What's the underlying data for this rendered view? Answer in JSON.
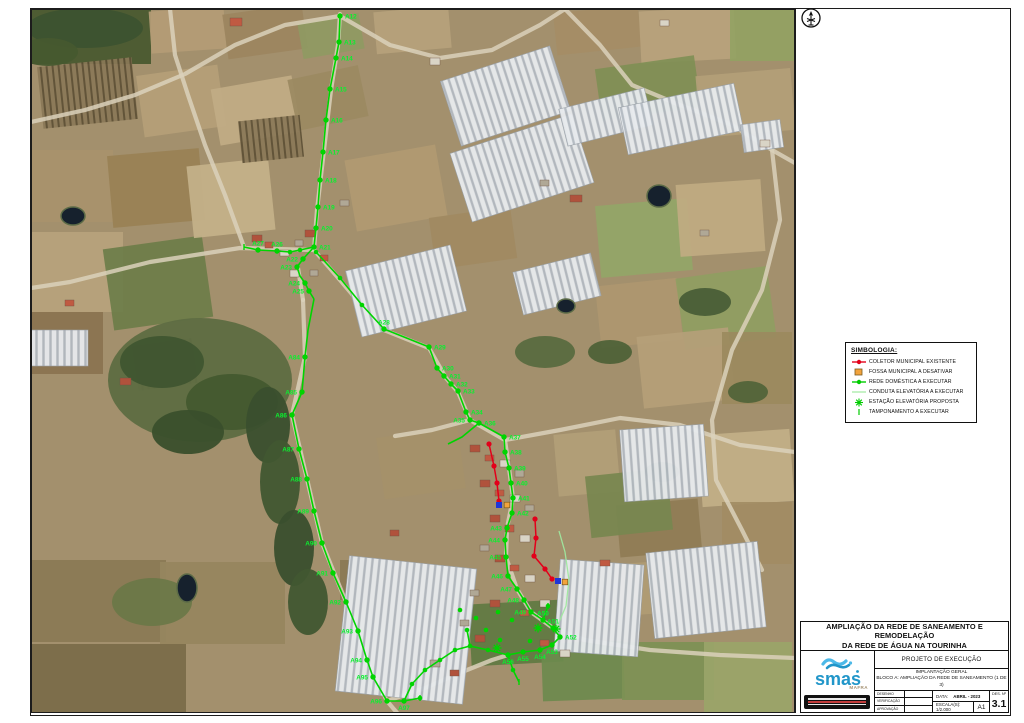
{
  "sheet": {
    "title_line1": "AMPLIAÇÃO DA  REDE DE SANEAMENTO E REMODELAÇÃO",
    "title_line2": "DA REDE DE ÁGUA NA TOURINHA",
    "project_phase": "PROJETO DE EXECUÇÃO",
    "subtitle1": "IMPLANTAÇÃO GERAL",
    "subtitle2": "BLOCO A: AMPLIAÇÃO DA REDE DE SANEAMENTO (1 DE 3)",
    "sign_rows": [
      {
        "label": "DESENHO"
      },
      {
        "label": "VERIFICAÇÃO"
      },
      {
        "label": "APROVAÇÃO"
      }
    ],
    "date_label": "DATA:",
    "date_value": "ABRIL - 2023",
    "scale_label": "ESCALA(S):  1/2.000",
    "format": "A1",
    "des_label": "DES. Nº",
    "des_number": "3.1",
    "logo_text": "smas",
    "logo_subtext": "MAFRA"
  },
  "legend": {
    "title": "SIMBOLOGIA:",
    "items": [
      {
        "symbol": "red-line-dot",
        "label": "COLETOR MUNICIPAL EXISTENTE",
        "color": "#e2001a"
      },
      {
        "symbol": "orange-square",
        "label": "FOSSA MUNICIPAL A DESATIVAR",
        "color": "#f2a33c"
      },
      {
        "symbol": "green-line-dot",
        "label": "REDE DOMÉSTICA A EXECUTAR",
        "color": "#00cc00"
      },
      {
        "symbol": "pale-green-line",
        "label": "CONDUTA ELEVATÓRIA A EXECUTAR",
        "color": "#9fe89f"
      },
      {
        "symbol": "green-star",
        "label": "ESTAÇÃO ELEVATÓRIA PROPOSTA",
        "color": "#00cc00"
      },
      {
        "symbol": "green-tick",
        "label": "TAMPONAMENTO A EXECUTAR",
        "color": "#00cc00"
      }
    ]
  },
  "map": {
    "colors": {
      "network_green": "#00d400",
      "label_green": "#0bef2f",
      "coletor_red": "#e2001a",
      "fossa_orange": "#f2a33c",
      "marker_blue": "#1e36d9",
      "conduta_pale": "#9fe89f"
    },
    "nodes": [
      [
        "A12",
        340,
        16,
        "r"
      ],
      [
        "A13",
        339,
        42,
        "r"
      ],
      [
        "A14",
        336,
        58,
        "r"
      ],
      [
        "A15",
        330,
        89,
        "r"
      ],
      [
        "A16",
        326,
        120,
        "r"
      ],
      [
        "A17",
        323,
        152,
        "r"
      ],
      [
        "A18",
        320,
        180,
        "r"
      ],
      [
        "A19",
        318,
        207,
        "r"
      ],
      [
        "A20",
        316,
        228,
        "r"
      ],
      [
        "A21",
        314,
        247,
        "r"
      ],
      [
        "A27",
        258,
        250,
        "t"
      ],
      [
        "A26",
        277,
        251,
        "t"
      ],
      [
        "A22",
        303,
        259,
        "l"
      ],
      [
        "A23",
        297,
        267,
        "l"
      ],
      [
        "A24",
        305,
        283,
        "l"
      ],
      [
        "A25",
        309,
        291,
        "l"
      ],
      [
        "A28",
        384,
        329,
        "t"
      ],
      [
        "A29",
        429,
        347,
        "r"
      ],
      [
        "A30",
        437,
        368,
        "r"
      ],
      [
        "A31",
        444,
        376,
        "r"
      ],
      [
        "A32",
        451,
        384,
        "r"
      ],
      [
        "A33",
        458,
        391,
        "r"
      ],
      [
        "A34",
        466,
        412,
        "r"
      ],
      [
        "A35",
        470,
        420,
        "l"
      ],
      [
        "A36",
        479,
        423,
        "r"
      ],
      [
        "A37",
        504,
        437,
        "r"
      ],
      [
        "A38",
        505,
        452,
        "r"
      ],
      [
        "A39",
        509,
        468,
        "r"
      ],
      [
        "A40",
        511,
        483,
        "r"
      ],
      [
        "A41",
        513,
        498,
        "r"
      ],
      [
        "A42",
        512,
        513,
        "r"
      ],
      [
        "A43",
        507,
        528,
        "l"
      ],
      [
        "A44",
        505,
        540,
        "l"
      ],
      [
        "A45",
        506,
        557,
        "l"
      ],
      [
        "A46",
        508,
        576,
        "l"
      ],
      [
        "A47",
        517,
        589,
        "l"
      ],
      [
        "A48",
        524,
        600,
        "l"
      ],
      [
        "A49",
        531,
        612,
        "l"
      ],
      [
        "A50",
        543,
        620,
        "t"
      ],
      [
        "A51",
        553,
        628,
        "t"
      ],
      [
        "A52",
        560,
        637,
        "r"
      ],
      [
        "A53",
        552,
        645,
        "b"
      ],
      [
        "A54",
        540,
        650,
        "b"
      ],
      [
        "A55",
        523,
        652,
        "b"
      ],
      [
        "A56",
        508,
        655,
        "b"
      ],
      [
        "A97",
        404,
        701,
        "b"
      ],
      [
        "A84",
        305,
        357,
        "l"
      ],
      [
        "A85",
        302,
        392,
        "l"
      ],
      [
        "A86",
        292,
        415,
        "l"
      ],
      [
        "A87",
        299,
        449,
        "l"
      ],
      [
        "A88",
        307,
        479,
        "l"
      ],
      [
        "A89",
        314,
        511,
        "l"
      ],
      [
        "A90",
        322,
        543,
        "l"
      ],
      [
        "A91",
        333,
        573,
        "l"
      ],
      [
        "A92",
        346,
        602,
        "l"
      ],
      [
        "A93",
        358,
        631,
        "l"
      ],
      [
        "A94",
        367,
        660,
        "l"
      ],
      [
        "A95",
        373,
        677,
        "l"
      ],
      [
        "A96",
        387,
        701,
        "l"
      ]
    ],
    "green_edges": [
      [
        [
          340,
          16
        ],
        [
          339,
          42
        ],
        [
          336,
          58
        ],
        [
          330,
          89
        ],
        [
          326,
          120
        ],
        [
          323,
          152
        ],
        [
          320,
          180
        ],
        [
          318,
          207
        ],
        [
          316,
          228
        ],
        [
          314,
          247
        ]
      ],
      [
        [
          314,
          247
        ],
        [
          300,
          250
        ],
        [
          290,
          252
        ],
        [
          277,
          251
        ],
        [
          258,
          250
        ],
        [
          244,
          247
        ]
      ],
      [
        [
          314,
          247
        ],
        [
          303,
          259
        ],
        [
          297,
          267
        ],
        [
          300,
          276
        ],
        [
          305,
          283
        ],
        [
          309,
          291
        ],
        [
          314,
          299
        ]
      ],
      [
        [
          314,
          299
        ],
        [
          308,
          330
        ],
        [
          305,
          357
        ],
        [
          302,
          392
        ],
        [
          292,
          415
        ],
        [
          299,
          449
        ],
        [
          307,
          479
        ],
        [
          314,
          511
        ],
        [
          322,
          543
        ],
        [
          333,
          573
        ],
        [
          346,
          602
        ],
        [
          358,
          631
        ],
        [
          367,
          660
        ],
        [
          373,
          677
        ],
        [
          387,
          701
        ],
        [
          404,
          701
        ],
        [
          420,
          698
        ]
      ],
      [
        [
          316,
          252
        ],
        [
          340,
          278
        ],
        [
          362,
          305
        ],
        [
          384,
          329
        ],
        [
          429,
          347
        ],
        [
          437,
          368
        ],
        [
          444,
          376
        ],
        [
          451,
          384
        ],
        [
          458,
          391
        ],
        [
          466,
          412
        ],
        [
          470,
          420
        ],
        [
          479,
          423
        ],
        [
          504,
          437
        ],
        [
          505,
          452
        ],
        [
          509,
          468
        ],
        [
          511,
          483
        ],
        [
          513,
          498
        ],
        [
          512,
          513
        ],
        [
          507,
          528
        ],
        [
          505,
          540
        ],
        [
          506,
          557
        ],
        [
          508,
          576
        ],
        [
          517,
          589
        ],
        [
          524,
          600
        ],
        [
          531,
          612
        ],
        [
          543,
          620
        ],
        [
          553,
          628
        ]
      ],
      [
        [
          479,
          423
        ],
        [
          462,
          437
        ],
        [
          448,
          444
        ]
      ],
      [
        [
          553,
          628
        ],
        [
          560,
          637
        ],
        [
          552,
          645
        ],
        [
          540,
          650
        ],
        [
          523,
          652
        ],
        [
          508,
          655
        ],
        [
          488,
          650
        ],
        [
          470,
          646
        ],
        [
          455,
          650
        ],
        [
          440,
          660
        ],
        [
          425,
          670
        ],
        [
          412,
          684
        ],
        [
          404,
          701
        ]
      ],
      [
        [
          508,
          655
        ],
        [
          513,
          670
        ],
        [
          519,
          682
        ]
      ],
      [
        [
          470,
          646
        ],
        [
          467,
          630
        ]
      ],
      [
        [
          543,
          620
        ],
        [
          548,
          606
        ]
      ]
    ],
    "extra_dots": [
      [
        300,
        250
      ],
      [
        290,
        252
      ],
      [
        316,
        252
      ],
      [
        340,
        278
      ],
      [
        362,
        305
      ],
      [
        488,
        650
      ],
      [
        470,
        646
      ],
      [
        455,
        650
      ],
      [
        440,
        660
      ],
      [
        425,
        670
      ],
      [
        412,
        684
      ],
      [
        467,
        630
      ],
      [
        513,
        670
      ],
      [
        548,
        606
      ],
      [
        420,
        698
      ],
      [
        460,
        610
      ],
      [
        476,
        618
      ],
      [
        498,
        612
      ],
      [
        512,
        620
      ],
      [
        530,
        641
      ],
      [
        500,
        640
      ],
      [
        486,
        630
      ]
    ],
    "red_segments": [
      [
        [
          489,
          444
        ],
        [
          494,
          466
        ],
        [
          497,
          483
        ],
        [
          499,
          501
        ]
      ],
      [
        [
          535,
          519
        ],
        [
          536,
          538
        ],
        [
          534,
          556
        ],
        [
          545,
          569
        ],
        [
          552,
          579
        ]
      ]
    ],
    "blue_markers": [
      [
        499,
        505
      ],
      [
        558,
        581
      ]
    ],
    "orange_markers": [
      [
        507,
        505
      ],
      [
        565,
        582
      ]
    ],
    "stars": [
      [
        538,
        628
      ],
      [
        556,
        629
      ],
      [
        497,
        648
      ]
    ],
    "ticks": [
      [
        244,
        247
      ],
      [
        420,
        698
      ],
      [
        519,
        682
      ],
      [
        548,
        606
      ]
    ],
    "pale_edge": [
      [
        556,
        629
      ],
      [
        566,
        606
      ],
      [
        569,
        580
      ],
      [
        565,
        552
      ],
      [
        559,
        531
      ]
    ]
  }
}
